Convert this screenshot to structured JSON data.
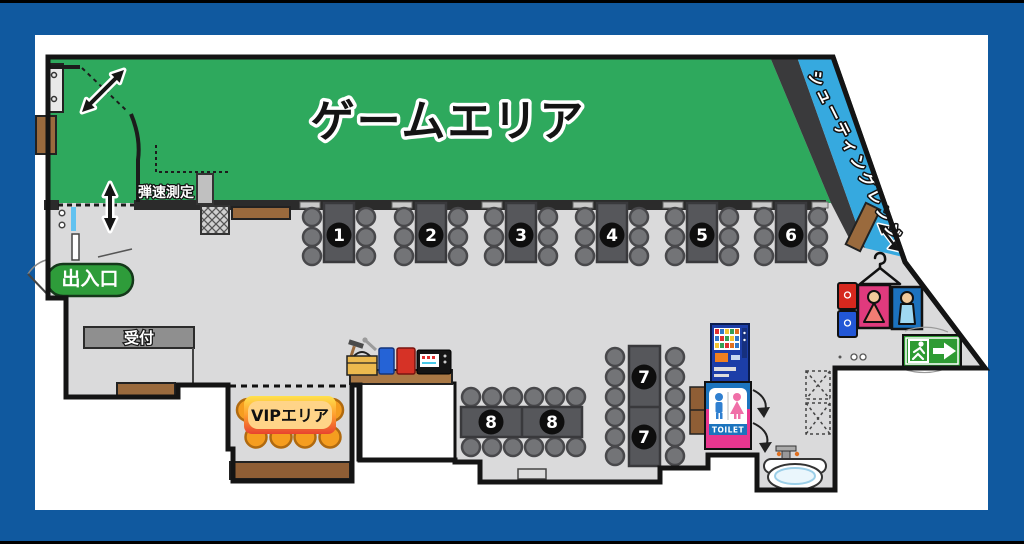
{
  "colors": {
    "frame": "#10599F",
    "canvas": "#FFFFFF",
    "floor": "#DADADB",
    "wall": "#141414",
    "game_area": "#2EA95D",
    "shooting_range": "#36A9DF",
    "entrance_badge": "#2E9C3A",
    "exit_sign": "#2E9B33",
    "vip_chair": "#F59D1F",
    "toilet_pink": "#E8368F",
    "toilet_blue": "#1B74BE",
    "wood": "#9A6A3D",
    "table_gray": "#56575B",
    "chair_gray": "#737477"
  },
  "areas": {
    "game_area_label": "ゲームエリア",
    "shooting_range_label": "シューティングレンジ",
    "vip_label": "VIPエリア"
  },
  "labels": {
    "entrance": "出入口",
    "reception": "受付",
    "chrono_check": "弾速測定",
    "toilet_sign": "TOILET"
  },
  "tables": [
    {
      "label": "1"
    },
    {
      "label": "2"
    },
    {
      "label": "3"
    },
    {
      "label": "4"
    },
    {
      "label": "5"
    },
    {
      "label": "6"
    },
    {
      "label": "7"
    },
    {
      "label": "8"
    }
  ]
}
